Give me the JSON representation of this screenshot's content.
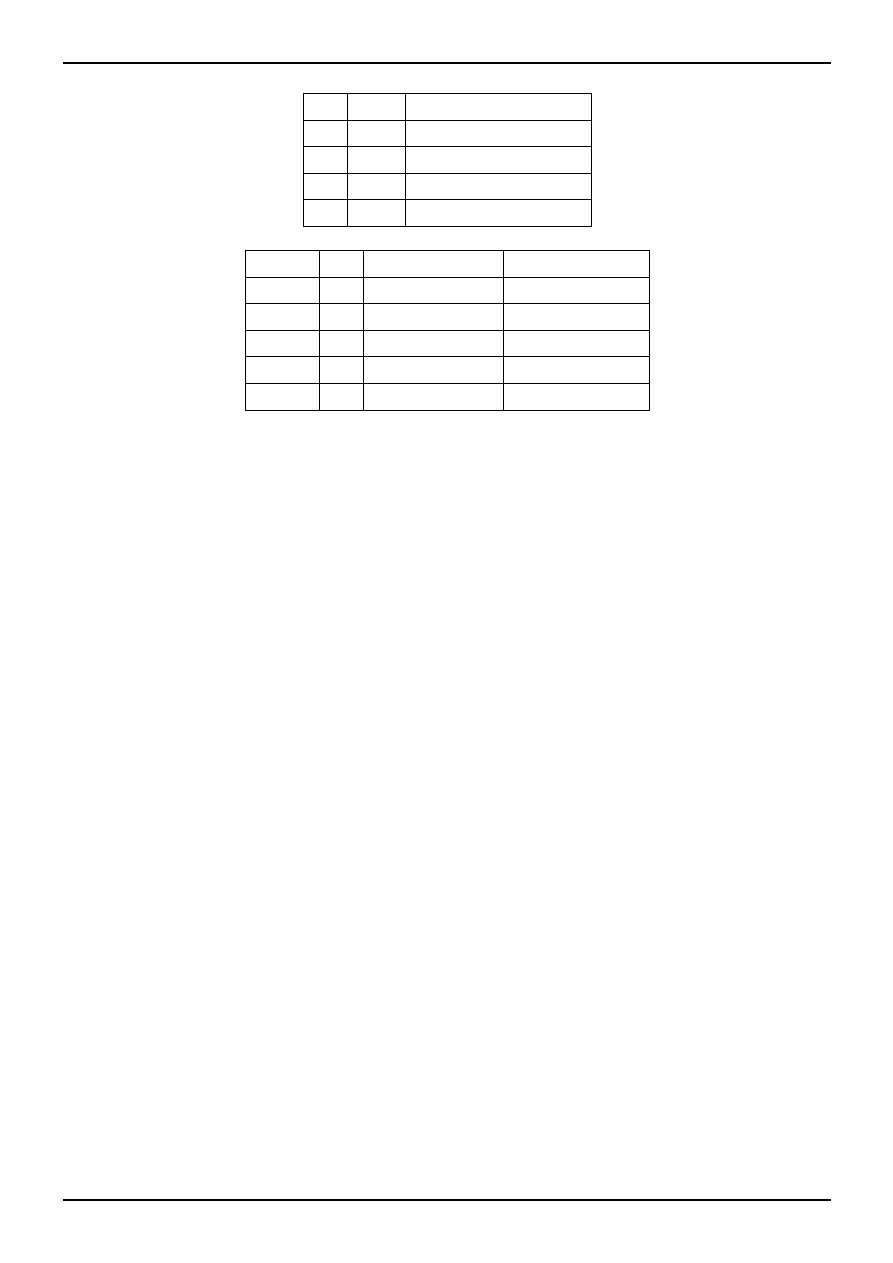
{
  "page": {
    "background_color": "#ffffff",
    "rule_color": "#000000",
    "table_border_color": "#000000",
    "visible_text": ""
  },
  "tables": [
    {
      "id": "table-1",
      "column_count": 3,
      "row_count": 5,
      "col_widths": [
        44,
        58,
        186
      ],
      "rows": [
        [
          "",
          "",
          ""
        ],
        [
          "",
          "",
          ""
        ],
        [
          "",
          "",
          ""
        ],
        [
          "",
          "",
          ""
        ],
        [
          "",
          "",
          ""
        ]
      ]
    },
    {
      "id": "table-2",
      "column_count": 4,
      "row_count": 6,
      "col_widths": [
        74,
        44,
        140,
        146
      ],
      "rows": [
        [
          "",
          "",
          "",
          ""
        ],
        [
          "",
          "",
          "",
          ""
        ],
        [
          "",
          "",
          "",
          ""
        ],
        [
          "",
          "",
          "",
          ""
        ],
        [
          "",
          "",
          "",
          ""
        ],
        [
          "",
          "",
          "",
          ""
        ]
      ]
    }
  ]
}
